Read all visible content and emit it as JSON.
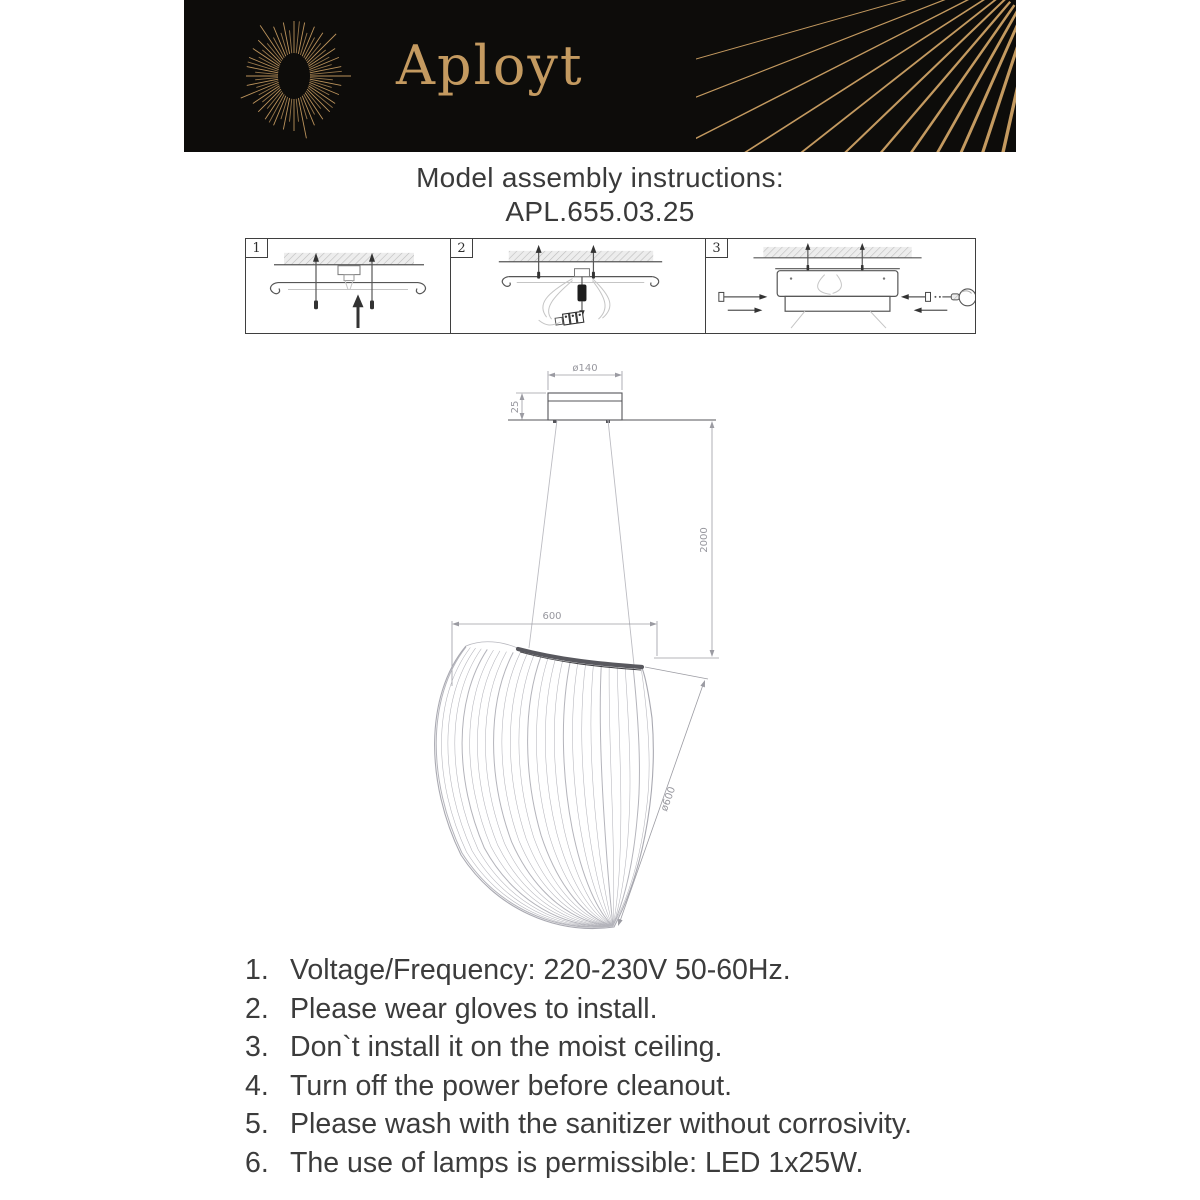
{
  "brand": {
    "name": "Aployt"
  },
  "title": {
    "line1": "Model assembly instructions:",
    "line2": "APL.655.03.25"
  },
  "steps": [
    {
      "number": "1"
    },
    {
      "number": "2"
    },
    {
      "number": "3"
    }
  ],
  "dimensions": {
    "canopy_diameter": "ø140",
    "canopy_height": "25",
    "suspension_height": "2000",
    "shade_width": "600",
    "shade_diameter": "ø600"
  },
  "instructions": {
    "items": [
      {
        "num": "1.",
        "text": "Voltage/Frequency: 220-230V 50-60Hz."
      },
      {
        "num": "2.",
        "text": "Please wear gloves to install."
      },
      {
        "num": "3.",
        "text": "Don`t install it on the moist ceiling."
      },
      {
        "num": "4.",
        "text": "Turn off the power before cleanout."
      },
      {
        "num": "5.",
        "text": "Please wash with the sanitizer without corrosivity."
      },
      {
        "num": "6.",
        "text": "The use of lamps is permissible: LED 1x25W."
      }
    ]
  },
  "colors": {
    "gold": "#c49a60",
    "banner_black": "#0d0c0a"
  }
}
